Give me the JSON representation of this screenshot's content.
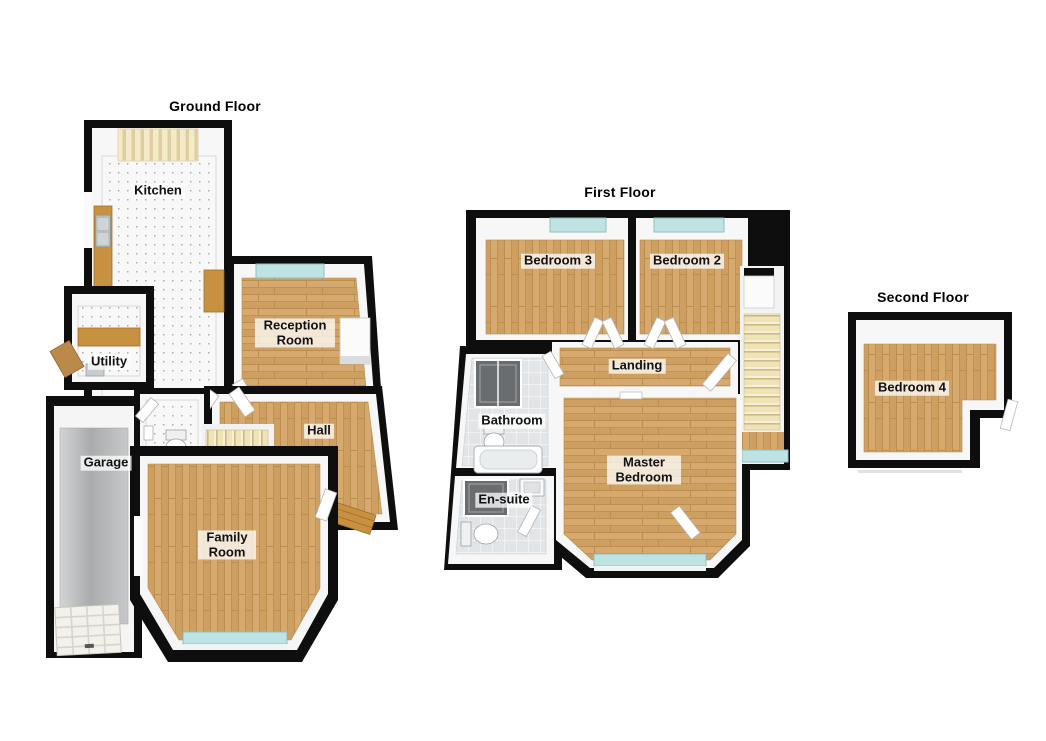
{
  "floorplan": {
    "type": "3d-floorplan",
    "floors": [
      {
        "title": "Ground Floor",
        "rooms": [
          {
            "label": "Kitchen"
          },
          {
            "label": "Utility"
          },
          {
            "label": "Garage"
          },
          {
            "label": "Reception Room"
          },
          {
            "label": "Hall"
          },
          {
            "label": "Family Room"
          }
        ]
      },
      {
        "title": "First Floor",
        "rooms": [
          {
            "label": "Bedroom 3"
          },
          {
            "label": "Bedroom 2"
          },
          {
            "label": "Landing"
          },
          {
            "label": "Bathroom"
          },
          {
            "label": "En-suite"
          },
          {
            "label": "Master Bedroom"
          }
        ]
      },
      {
        "title": "Second Floor",
        "rooms": [
          {
            "label": "Bedroom 4"
          }
        ]
      }
    ],
    "colors": {
      "outer_wall": "#0e0e0e",
      "inner_wall": "#f7f7f7",
      "wood_floor": "#d2a266",
      "wood_counter": "#c8913f",
      "window_glass": "#bfe3e3",
      "stairs": "#efe3b8",
      "garage_floor": "#b7b9bb",
      "bathroom_tile": "#e2e5e7",
      "kitchen_floor": "#f8f8f8",
      "background": "#ffffff"
    }
  }
}
